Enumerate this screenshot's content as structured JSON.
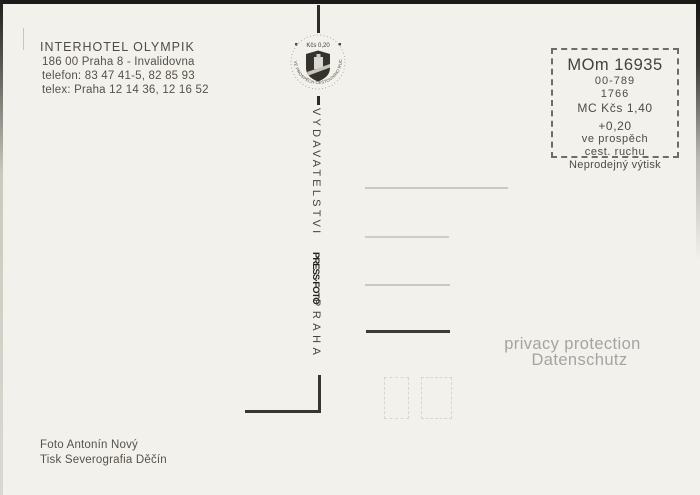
{
  "hotel_info": {
    "name": "INTERHOTEL OLYMPIK",
    "address": "186 00 Praha 8 - Invalidovna",
    "telefon": "telefon: 83 47 41-5, 82 85 93",
    "telex": "telex: Praha 12 14 36,  12 16 52"
  },
  "tax_stamp": {
    "value": "Kčs  0,20",
    "arc_text": "VE PROSPĚCH CESTOVNÍHO RUCHU"
  },
  "center_column": {
    "publisher": "VYDAVATELSTVI",
    "logo": "PRESS·FOTO",
    "city": "PRAHA"
  },
  "price_box": {
    "code": "MOm 16935",
    "number1": "00-789",
    "number2": "1766",
    "price": "MC  Kčs 1,40",
    "surcharge": "+0,20",
    "purpose1": "ve prospěch",
    "purpose2": "cest. ruchu",
    "note": "Neprodejný výtisk"
  },
  "watermark": {
    "line1": "privacy protection",
    "line2": "Datenschutz"
  },
  "credits": {
    "photo": "Foto Antonín Nový",
    "print": "Tisk Severografia Děčín"
  },
  "colors": {
    "paper": "#f3f1eb",
    "ink": "#56524a",
    "divider": "#2d2c29",
    "line_light": "#cbc8c1",
    "line_dark": "#3d3b35",
    "watermark": "#a4a4a3"
  }
}
